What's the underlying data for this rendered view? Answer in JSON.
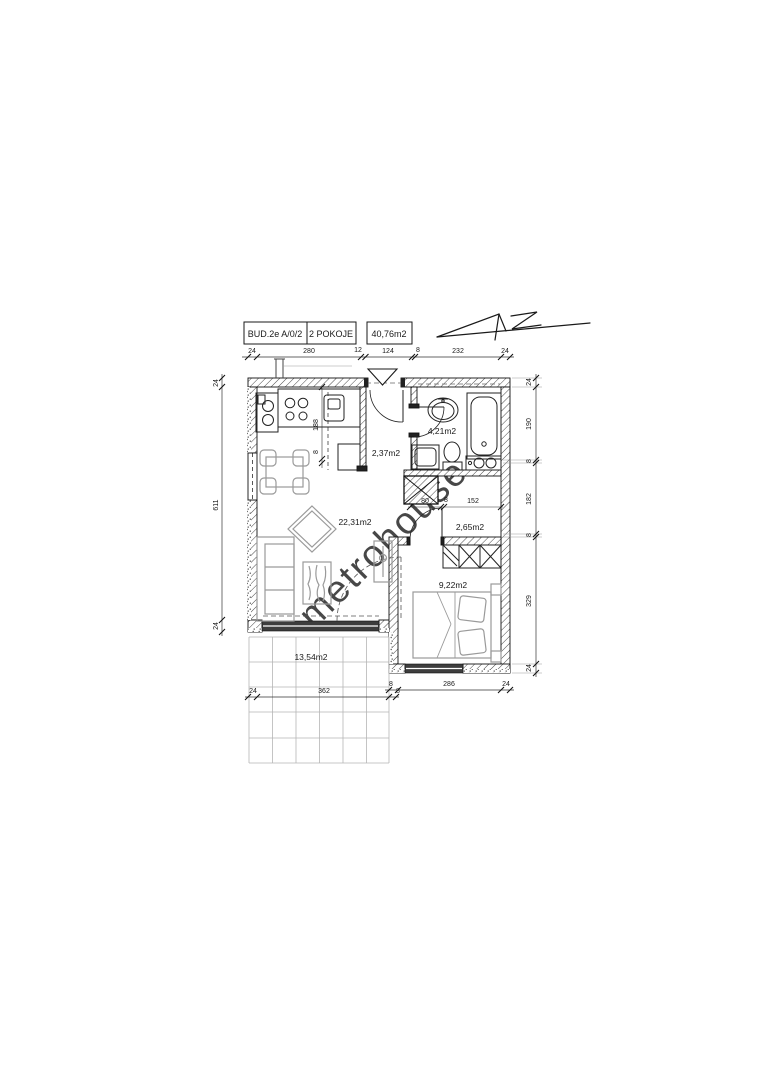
{
  "title_block": {
    "building": "BUD.2e  A/0/2",
    "rooms": "2 POKOJE",
    "total_area": "40,76m2"
  },
  "watermark": "metrohouse",
  "areas": {
    "living_kitchen": "22,31m2",
    "entrance_hall": "2,37m2",
    "bathroom": "4,21m2",
    "corridor": "2,65m2",
    "bedroom": "9,22m2",
    "terrace": "13,54m2"
  },
  "dims": {
    "top": [
      "24",
      "280",
      "12",
      "124",
      "8",
      "232",
      "24"
    ],
    "left": [
      "24",
      "611",
      "24"
    ],
    "right": [
      "24",
      "190",
      "8",
      "182",
      "8",
      "329",
      "24"
    ],
    "bedroom_bottom": [
      "8",
      "286",
      "24"
    ],
    "terrace": [
      "24",
      "362",
      "8"
    ],
    "kitchen": [
      "188",
      "8"
    ],
    "corridor": [
      "80",
      "8",
      "152"
    ]
  },
  "colors": {
    "line": "#1a1a1a",
    "furniture_gray": "#9a9a9a",
    "window_dark": "#3d3d3d",
    "watermark_gray": "#c9c9c9"
  }
}
